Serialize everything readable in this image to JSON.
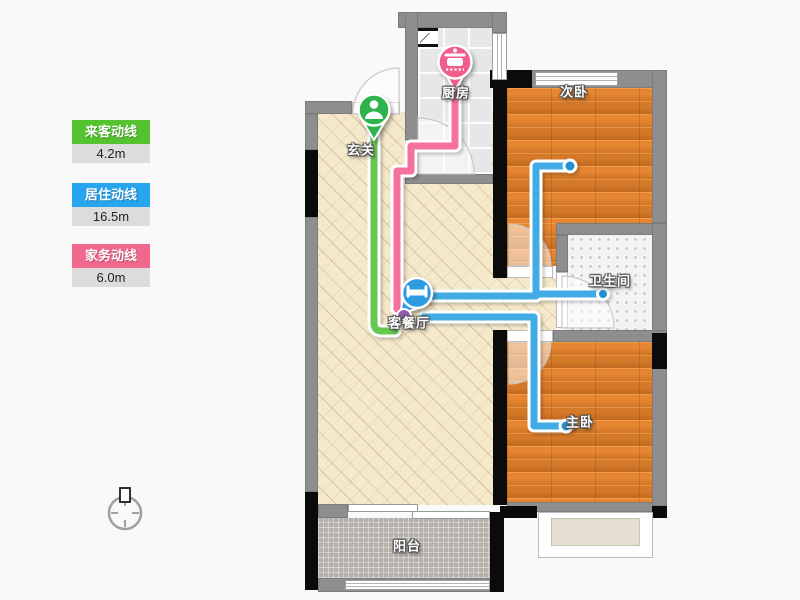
{
  "legend": {
    "items": [
      {
        "label": "来客动线",
        "value": "4.2m",
        "color": "#54c32f"
      },
      {
        "label": "居住动线",
        "value": "16.5m",
        "color": "#27a5ee"
      },
      {
        "label": "家务动线",
        "value": "6.0m",
        "color": "#f2688c"
      }
    ]
  },
  "rooms": {
    "entry": "玄关",
    "kitchen": "厨房",
    "second_bedroom": "次卧",
    "bathroom": "卫生间",
    "living_dining": "客餐厅",
    "master_bedroom": "主卧",
    "balcony": "阳台"
  },
  "pins": {
    "entry_icon": "person-icon",
    "kitchen_icon": "pot-icon",
    "living_icon": "bed-icon"
  },
  "colors": {
    "visitor_line": "#66c94f",
    "resident_line": "#41abe6",
    "housework_line": "#f4729c",
    "endpoint_dot": "#2391cf",
    "wall_gray": "#8e8e8e",
    "wall_black": "#0b0b0b",
    "floor_beige": "#f5e9cb",
    "floor_wood": "#e0832e",
    "floor_kitchen": "#e7e7e7",
    "floor_bathroom": "#f2f4f4",
    "floor_balcony": "#b5b1aa"
  }
}
